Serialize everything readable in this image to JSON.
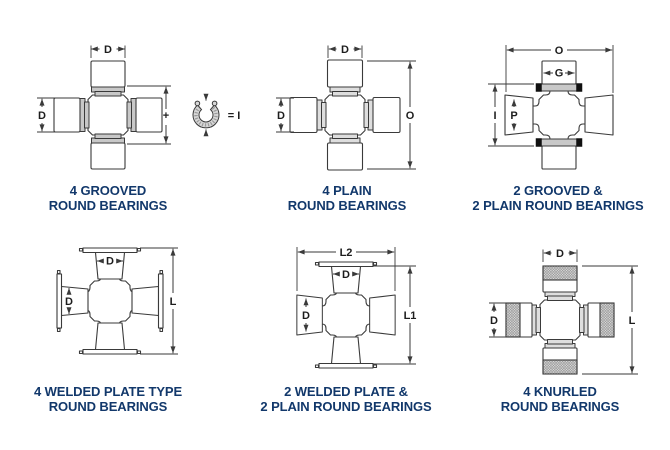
{
  "theme": {
    "background": "#ffffff",
    "caption_color": "#12386b",
    "line_color": "#3a3a3a",
    "groove_gray": "#c8c8c8",
    "snap_ring_black": "#101010"
  },
  "panels": [
    {
      "line1": "4 GROOVED",
      "line2": "ROUND BEARINGS",
      "labels": {
        "top": "D",
        "left": "D",
        "mid": "+",
        "ring_eq": "= I"
      }
    },
    {
      "line1": "4 PLAIN",
      "line2": "ROUND BEARINGS",
      "labels": {
        "top": "D",
        "left": "D",
        "right": "O"
      }
    },
    {
      "line1": "2 GROOVED &",
      "line2": "2 PLAIN ROUND BEARINGS",
      "labels": {
        "top": "O",
        "cap_top": "G",
        "left": "I",
        "cap_left": "P"
      }
    },
    {
      "line1": "4 WELDED PLATE TYPE",
      "line2": "ROUND BEARINGS",
      "labels": {
        "cap_top": "D",
        "cap_left": "D",
        "right": "L"
      }
    },
    {
      "line1": "2 WELDED PLATE &",
      "line2": "2 PLAIN ROUND BEARINGS",
      "labels": {
        "top": "L2",
        "cap_top": "D",
        "cap_left": "D",
        "right": "L1"
      }
    },
    {
      "line1": "4 KNURLED",
      "line2": "ROUND BEARINGS",
      "labels": {
        "top": "D",
        "left": "D",
        "right": "L"
      }
    }
  ]
}
